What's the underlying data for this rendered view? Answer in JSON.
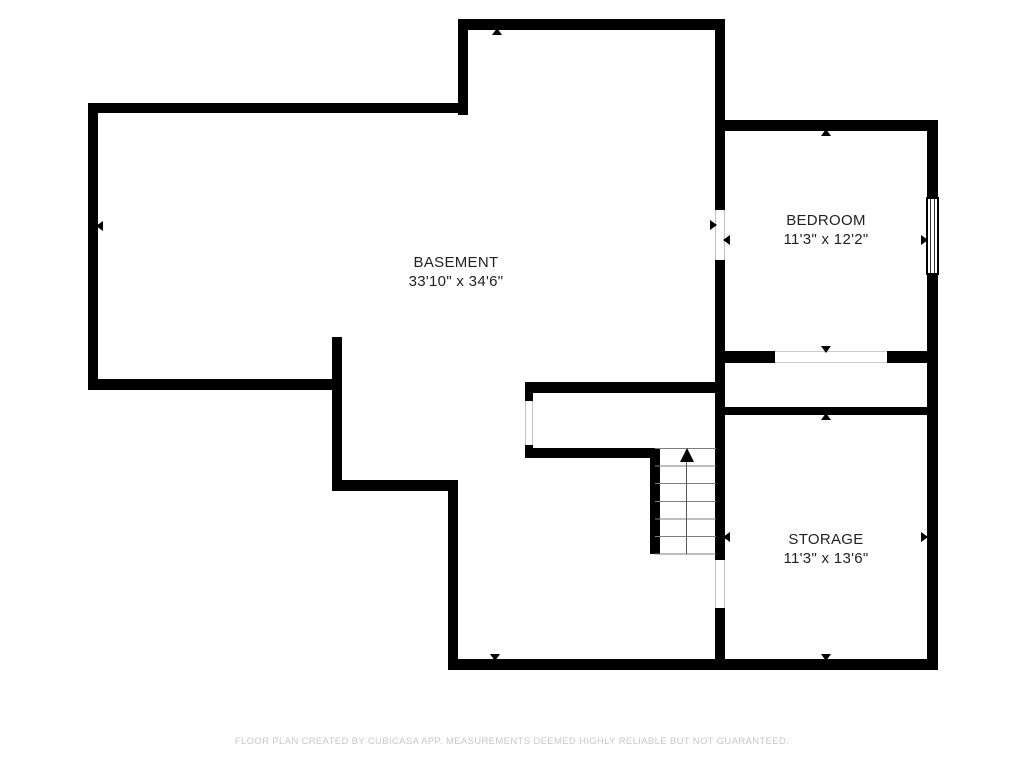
{
  "floorplan": {
    "rooms": [
      {
        "id": "basement",
        "name": "BASEMENT",
        "dimensions": "33'10\" x 34'6\""
      },
      {
        "id": "bedroom",
        "name": "BEDROOM",
        "dimensions": "11'3\" x 12'2\""
      },
      {
        "id": "storage",
        "name": "STORAGE",
        "dimensions": "11'3\" x 13'6\""
      }
    ],
    "features": {
      "staircase": {
        "steps": 6,
        "direction_arrow": "up"
      },
      "window_count": 1,
      "door_openings": 4
    },
    "icons": {
      "stairs_arrow": "stairs-direction-up-arrow",
      "wall_markers": "measurement-arrow"
    },
    "colors": {
      "wall": "#000000",
      "label_text": "#222222",
      "footer_text": "#c8c8c8",
      "stair_tread": "#7d7d7d",
      "door_jamb": "#c2c2c2"
    },
    "footer": "FLOOR PLAN CREATED BY CUBICASA APP. MEASUREMENTS DEEMED HIGHLY RELIABLE BUT NOT GUARANTEED."
  }
}
